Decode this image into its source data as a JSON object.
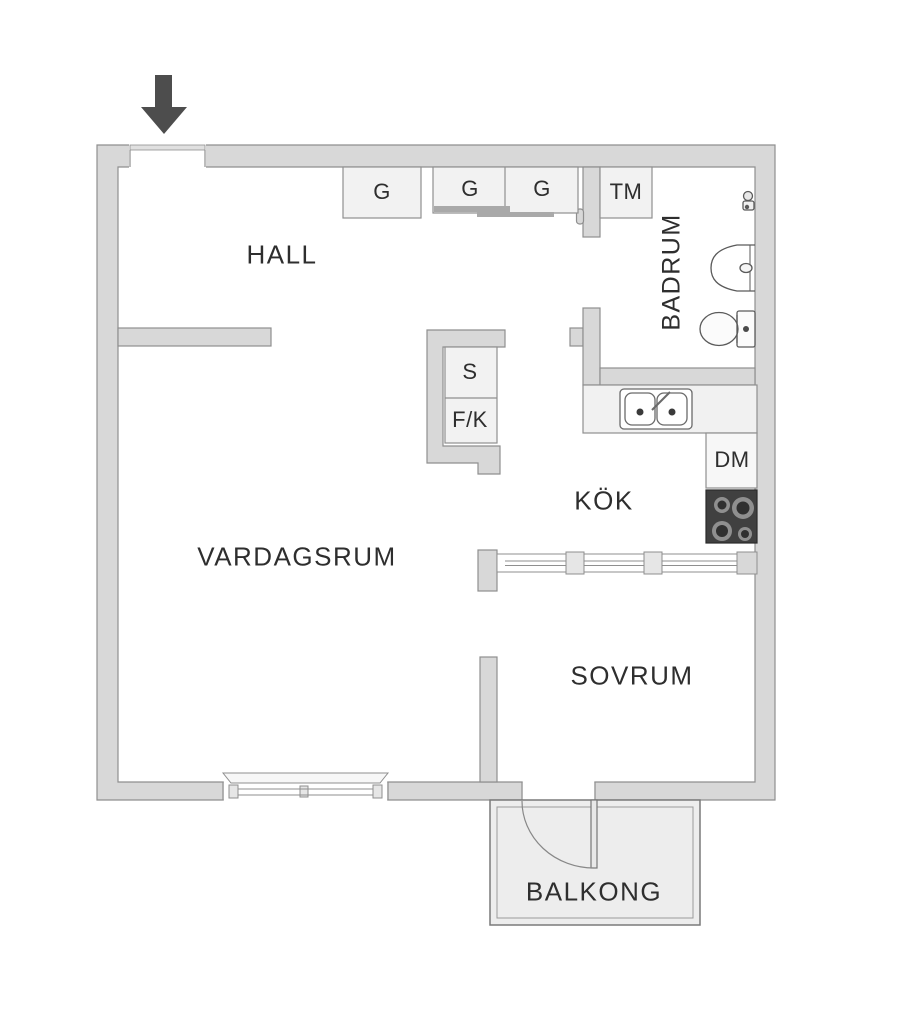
{
  "meta": {
    "title": "Apartment floor plan"
  },
  "rooms": {
    "hall": {
      "label": "HALL"
    },
    "bathroom": {
      "label": "BADRUM"
    },
    "kitchen": {
      "label": "KÖK"
    },
    "living_room": {
      "label": "VARDAGSRUM"
    },
    "bedroom": {
      "label": "SOVRUM"
    },
    "balcony": {
      "label": "BALKONG"
    }
  },
  "fixtures": {
    "wardrobe_1": {
      "label": "G"
    },
    "wardrobe_2": {
      "label": "G"
    },
    "wardrobe_3": {
      "label": "G"
    },
    "washing_machine": {
      "label": "TM"
    },
    "pantry": {
      "label": "S"
    },
    "fridge_freezer": {
      "label": "F/K"
    },
    "dishwasher": {
      "label": "DM"
    }
  },
  "icons": {
    "entrance": "arrow-down-icon",
    "bathroom_tap": "tap-icon",
    "washbasin": "washbasin-icon",
    "toilet": "toilet-icon",
    "kitchen_sink": "double-sink-icon",
    "stove": "stove-icon"
  },
  "colors": {
    "wall_fill": "#d8d8d8",
    "wall_stroke": "#8f8f8f",
    "box_fill": "#f2f2f2",
    "counter_fill": "#f1f1f1",
    "stove_fill": "#404040",
    "burner_ring": "#8f8f8f",
    "burner_center": "#303030",
    "arrow": "#4d4d4d",
    "balcony_fill": "#ededed",
    "text": "#2e2e2e"
  }
}
